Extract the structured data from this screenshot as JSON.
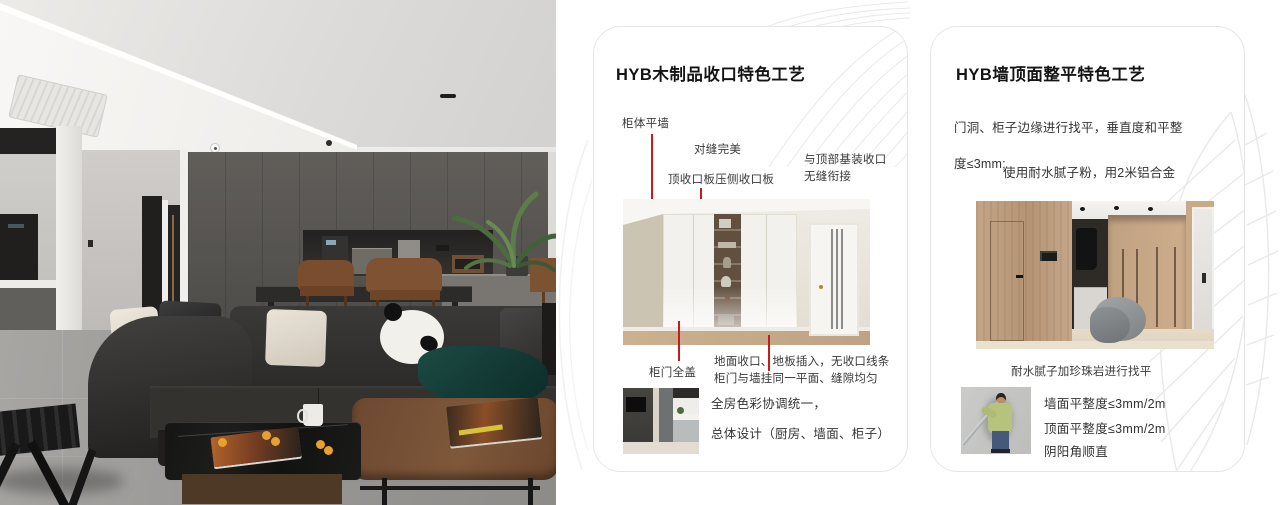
{
  "cards": {
    "woodwork": {
      "title": "HYB木制品收口特色工艺",
      "callouts": {
        "cabinet_flush_wall": "柜体平墙",
        "seam_perfect": "对缝完美",
        "top_trim_board": "顶收口板压侧收口板",
        "ceiling_joint_line1": "与顶部基装收口",
        "ceiling_joint_line2": "无缝衔接",
        "full_cover_door": "柜门全盖"
      },
      "caption_line1": "地面收口、地板插入，无收口线条",
      "caption_line2": "柜门与墙挂同一平面、缝隙均匀",
      "summary_line1": "全房色彩协调统一，",
      "summary_line2": "总体设计（厨房、墙面、柜子）"
    },
    "wall_leveling": {
      "title": "HYB墙顶面整平特色工艺",
      "para1_line1": "门洞、柜子边缘进行找平，垂直度和平整",
      "para1_line2": "度≤3mm;",
      "para2_line1": "使用耐水腻子粉，用2米铝合金",
      "para2_line2": "靠尺（批刮工具）批、刮平整。",
      "caption": "耐水腻子加珍珠岩进行找平",
      "bullet1": "墙面平整度≤3mm/2m",
      "bullet2": "顶面平整度≤3mm/2m",
      "bullet3": "阴阳角顺直"
    }
  },
  "colors": {
    "accent_red": "#c21e1e",
    "card_border": "#e6e6e6",
    "decor_line": "#e9e9e9"
  }
}
